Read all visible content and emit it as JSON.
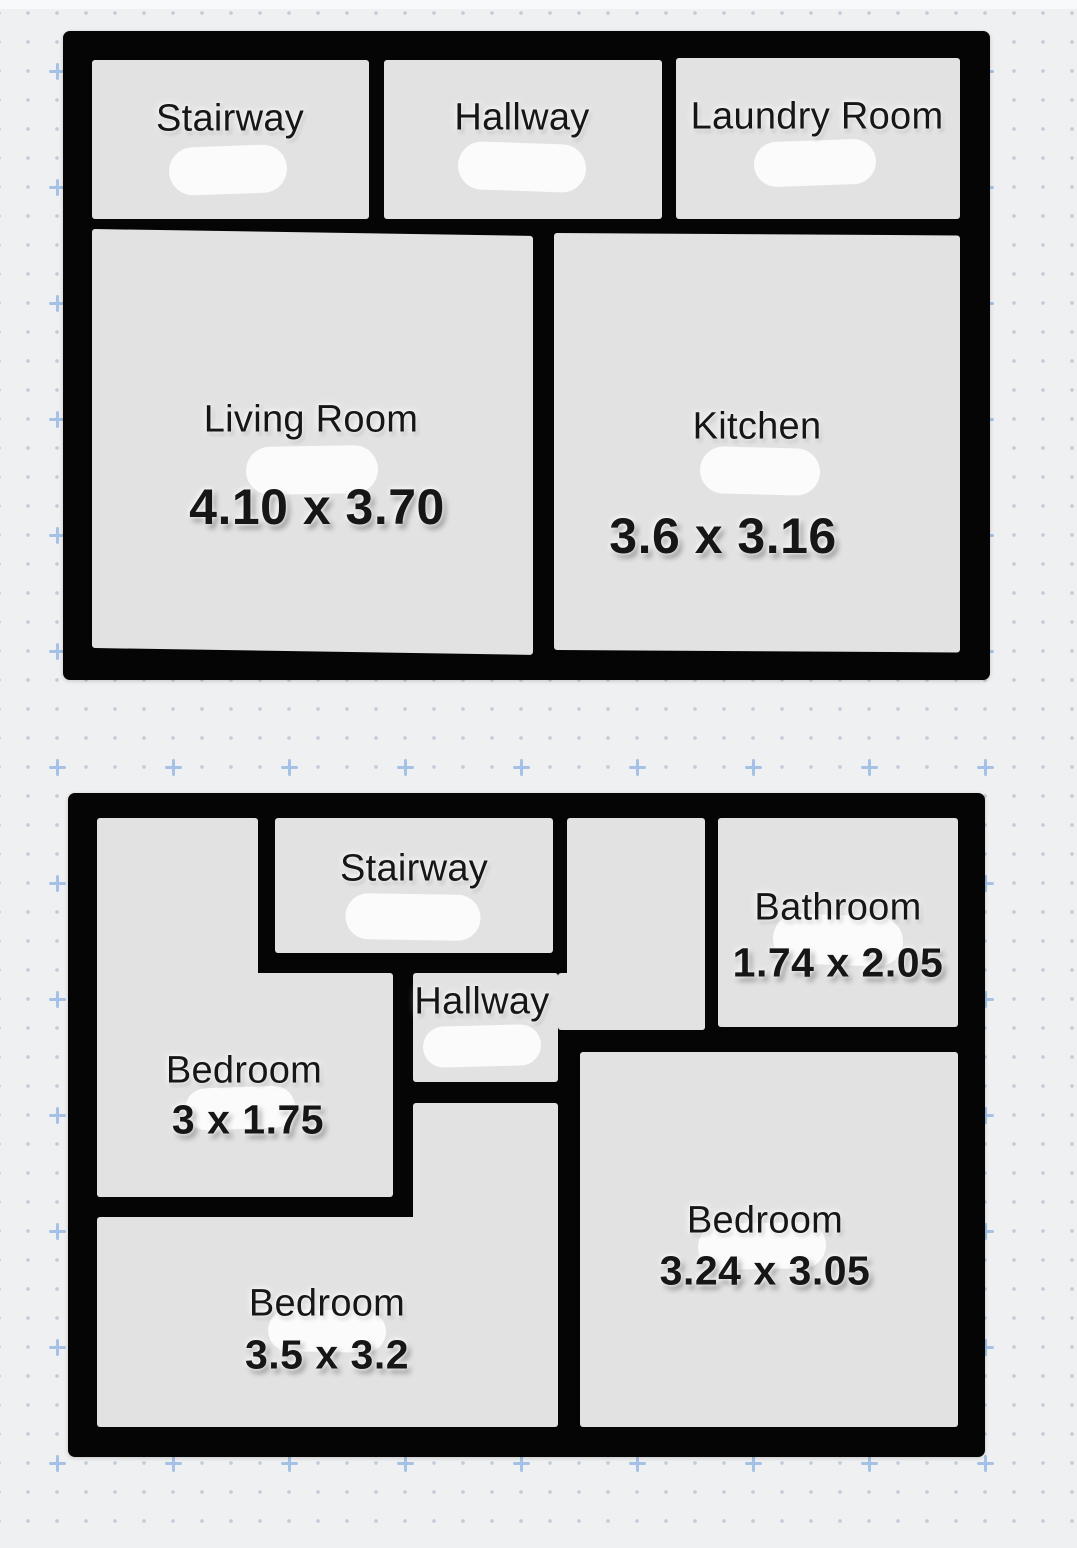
{
  "palette": {
    "background": "#eff0f2",
    "wall": "#050505",
    "room_fill": "#e2e2e3",
    "erase_mark": "#fbfbfc",
    "grid_dot": "#c3ccd9",
    "grid_plus": "#a5c2e6",
    "label_text": "#161616"
  },
  "grid": {
    "origin_x": 57,
    "origin_y": 71,
    "dot_spacing": 29,
    "plus_spacing": 116,
    "plus_cols": 9,
    "plus_rows": 13
  },
  "floors": [
    {
      "id": "upper",
      "frame": {
        "x": 63,
        "y": 31,
        "w": 927,
        "h": 649
      },
      "dims_font_size": 50,
      "rooms": [
        {
          "id": "stairway",
          "name": "Stairway",
          "dims": null,
          "rects": [
            {
              "x": 29,
              "y": 29,
              "w": 277,
              "h": 159
            }
          ],
          "label": {
            "x": 167,
            "y": 88
          },
          "dims_label": null,
          "blob": {
            "x": 165,
            "y": 139,
            "w": 118,
            "h": 48,
            "rot": -2
          }
        },
        {
          "id": "hallway",
          "name": "Hallway",
          "dims": null,
          "rects": [
            {
              "x": 321,
              "y": 29,
              "w": 278,
              "h": 159
            }
          ],
          "label": {
            "x": 459,
            "y": 87
          },
          "dims_label": null,
          "blob": {
            "x": 459,
            "y": 136,
            "w": 128,
            "h": 48,
            "rot": 2
          }
        },
        {
          "id": "laundry-room",
          "name": "Laundry Room",
          "dims": null,
          "rects": [
            {
              "x": 613,
              "y": 27,
              "w": 284,
              "h": 161
            }
          ],
          "label": {
            "x": 754,
            "y": 86
          },
          "dims_label": null,
          "blob": {
            "x": 752,
            "y": 132,
            "w": 122,
            "h": 45,
            "rot": -2
          }
        },
        {
          "id": "living-room",
          "name": "Living Room",
          "dims": "4.10 x 3.70",
          "rects": [
            {
              "x": 29,
              "y": 198,
              "w": 441,
              "h": 419,
              "skew": 0.9
            }
          ],
          "label": {
            "x": 248,
            "y": 389
          },
          "dims_label": {
            "x": 254,
            "y": 476
          },
          "blob": {
            "x": 249,
            "y": 439,
            "w": 132,
            "h": 48,
            "rot": -1
          }
        },
        {
          "id": "kitchen",
          "name": "Kitchen",
          "dims": "3.6 x 3.16",
          "rects": [
            {
              "x": 491,
              "y": 202,
              "w": 406,
              "h": 417,
              "skew": 0.35
            }
          ],
          "label": {
            "x": 694,
            "y": 396
          },
          "dims_label": {
            "x": 660,
            "y": 505
          },
          "blob": {
            "x": 697,
            "y": 440,
            "w": 120,
            "h": 47,
            "rot": 1.5
          }
        }
      ]
    },
    {
      "id": "lower",
      "frame": {
        "x": 68,
        "y": 793,
        "w": 917,
        "h": 664
      },
      "dims_font_size": 41,
      "rooms": [
        {
          "id": "bedroom-small",
          "name": "Bedroom",
          "dims": "3 x 1.75",
          "rects": [
            {
              "x": 29,
              "y": 25,
              "w": 161,
              "h": 379
            },
            {
              "x": 29,
              "y": 180,
              "w": 296,
              "h": 224
            }
          ],
          "label": {
            "x": 176,
            "y": 278
          },
          "dims_label": {
            "x": 180,
            "y": 327
          },
          "blob": {
            "x": 172,
            "y": 315,
            "w": 110,
            "h": 42,
            "rot": -2
          }
        },
        {
          "id": "stairway",
          "name": "Stairway",
          "dims": null,
          "rects": [
            {
              "x": 207,
              "y": 25,
              "w": 278,
              "h": 135
            }
          ],
          "label": {
            "x": 346,
            "y": 76
          },
          "dims_label": null,
          "blob": {
            "x": 345,
            "y": 124,
            "w": 135,
            "h": 46,
            "rot": 1
          }
        },
        {
          "id": "hallway",
          "name": "Hallway",
          "dims": null,
          "rects": [
            {
              "x": 345,
              "y": 180,
              "w": 145,
              "h": 109
            },
            {
              "x": 499,
              "y": 25,
              "w": 138,
              "h": 212
            },
            {
              "x": 490,
              "y": 180,
              "w": 147,
              "h": 57
            }
          ],
          "label": {
            "x": 414,
            "y": 209
          },
          "dims_label": null,
          "blob": {
            "x": 414,
            "y": 253,
            "w": 118,
            "h": 41,
            "rot": -1.5
          }
        },
        {
          "id": "bathroom",
          "name": "Bathroom",
          "dims": "1.74 x 2.05",
          "rects": [
            {
              "x": 650,
              "y": 25,
              "w": 240,
              "h": 209
            }
          ],
          "label": {
            "x": 770,
            "y": 115
          },
          "dims_label": {
            "x": 770,
            "y": 170
          },
          "blob": {
            "x": 770,
            "y": 147,
            "w": 130,
            "h": 50,
            "rot": 2
          }
        },
        {
          "id": "bedroom-bottom",
          "name": "Bedroom",
          "dims": "3.5 x 3.2",
          "rects": [
            {
              "x": 29,
              "y": 424,
              "w": 461,
              "h": 210
            },
            {
              "x": 345,
              "y": 310,
              "w": 145,
              "h": 120
            }
          ],
          "label": {
            "x": 259,
            "y": 511
          },
          "dims_label": {
            "x": 259,
            "y": 562
          },
          "blob": {
            "x": 259,
            "y": 538,
            "w": 118,
            "h": 42,
            "rot": 1
          }
        },
        {
          "id": "bedroom-right",
          "name": "Bedroom",
          "dims": "3.24 x 3.05",
          "rects": [
            {
              "x": 512,
              "y": 259,
              "w": 378,
              "h": 375
            }
          ],
          "label": {
            "x": 697,
            "y": 428
          },
          "dims_label": {
            "x": 697,
            "y": 478
          },
          "blob": {
            "x": 694,
            "y": 453,
            "w": 128,
            "h": 46,
            "rot": -1
          }
        }
      ]
    }
  ]
}
